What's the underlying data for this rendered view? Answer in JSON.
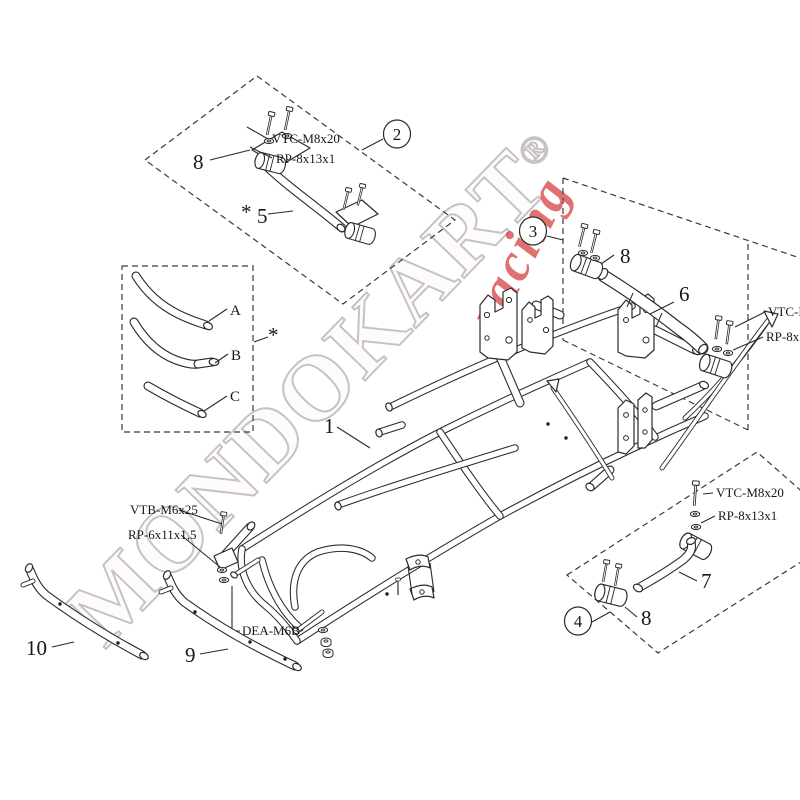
{
  "watermark": {
    "brand": "MONDOKART",
    "registered": "®",
    "accent": "racing",
    "gray": "#c8c2c2",
    "red": "#cf1b1b"
  },
  "boxes": {
    "box2": {
      "badge": "2",
      "clamp": "8",
      "bolt": "VTC-M8x20",
      "washer": "RP-8x13x1",
      "star": "*",
      "tube": "5"
    },
    "box_abc": {
      "tube_a": "A",
      "tube_b": "B",
      "tube_c": "C",
      "star": "*"
    },
    "box3": {
      "badge": "3",
      "clamp": "8",
      "tube": "6",
      "bolt": "VTC-M8x20",
      "washer": "RP-8x13x1"
    },
    "box4": {
      "badge": "4",
      "clamp": "8",
      "tube": "7",
      "bolt": "VTC-M8x20",
      "washer": "RP-8x13x1"
    }
  },
  "frame": {
    "label": "1",
    "bolt": "VTB-M6x25",
    "washer": "RP-6x11x1,5",
    "nut": "DEA-M6B"
  },
  "bumpers": {
    "side": "9",
    "front": "10"
  }
}
